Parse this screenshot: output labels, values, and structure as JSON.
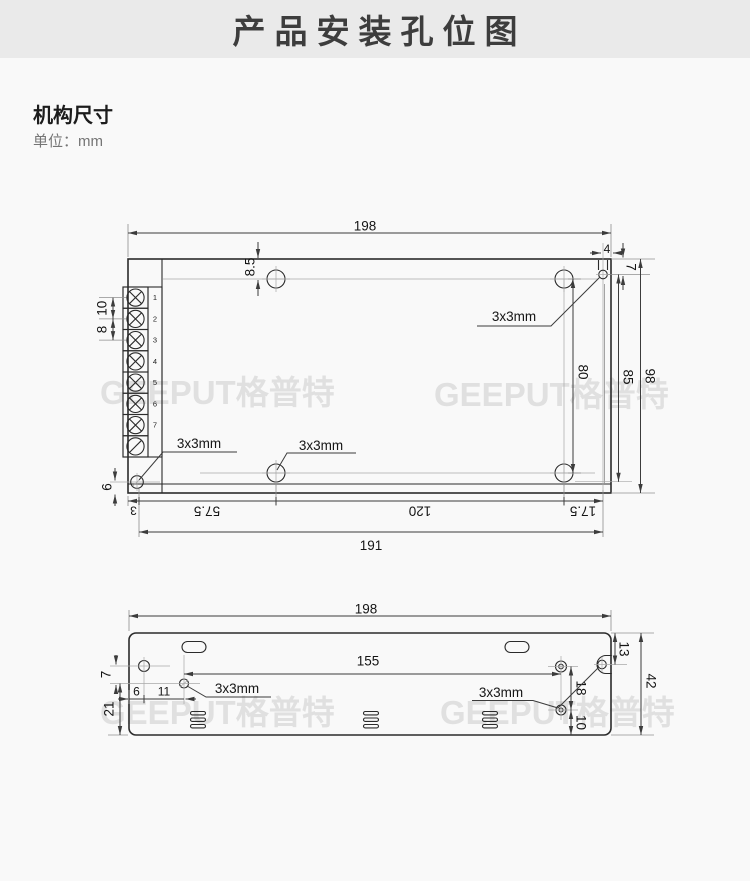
{
  "header": {
    "title": "产品安装孔位图"
  },
  "section": {
    "title": "机构尺寸",
    "unit": "单位：mm"
  },
  "watermark": {
    "text": "GEEPUT格普特"
  },
  "top_view": {
    "width": "198",
    "hole_top": "8.5",
    "flange_w": "4",
    "flange_top": "7",
    "pitch_a": "10",
    "pitch_b": "8",
    "holes_v": "80",
    "flange_v": "85",
    "height": "98",
    "corner_v": "6",
    "seg_edge": "3",
    "seg1": "57.5",
    "seg2": "120",
    "seg3": "17.5",
    "span": "191",
    "hole_label": "3x3mm",
    "terminals": [
      "1",
      "2",
      "3",
      "4",
      "5",
      "6",
      "7"
    ]
  },
  "bottom_view": {
    "width": "198",
    "span": "155",
    "top_v": "13",
    "height": "42",
    "row_v": "7",
    "edge_h": "6",
    "hole_h": "11",
    "bottom_v": "21",
    "holes_v": "18",
    "hole_bottom": "10",
    "hole_label": "3x3mm"
  }
}
